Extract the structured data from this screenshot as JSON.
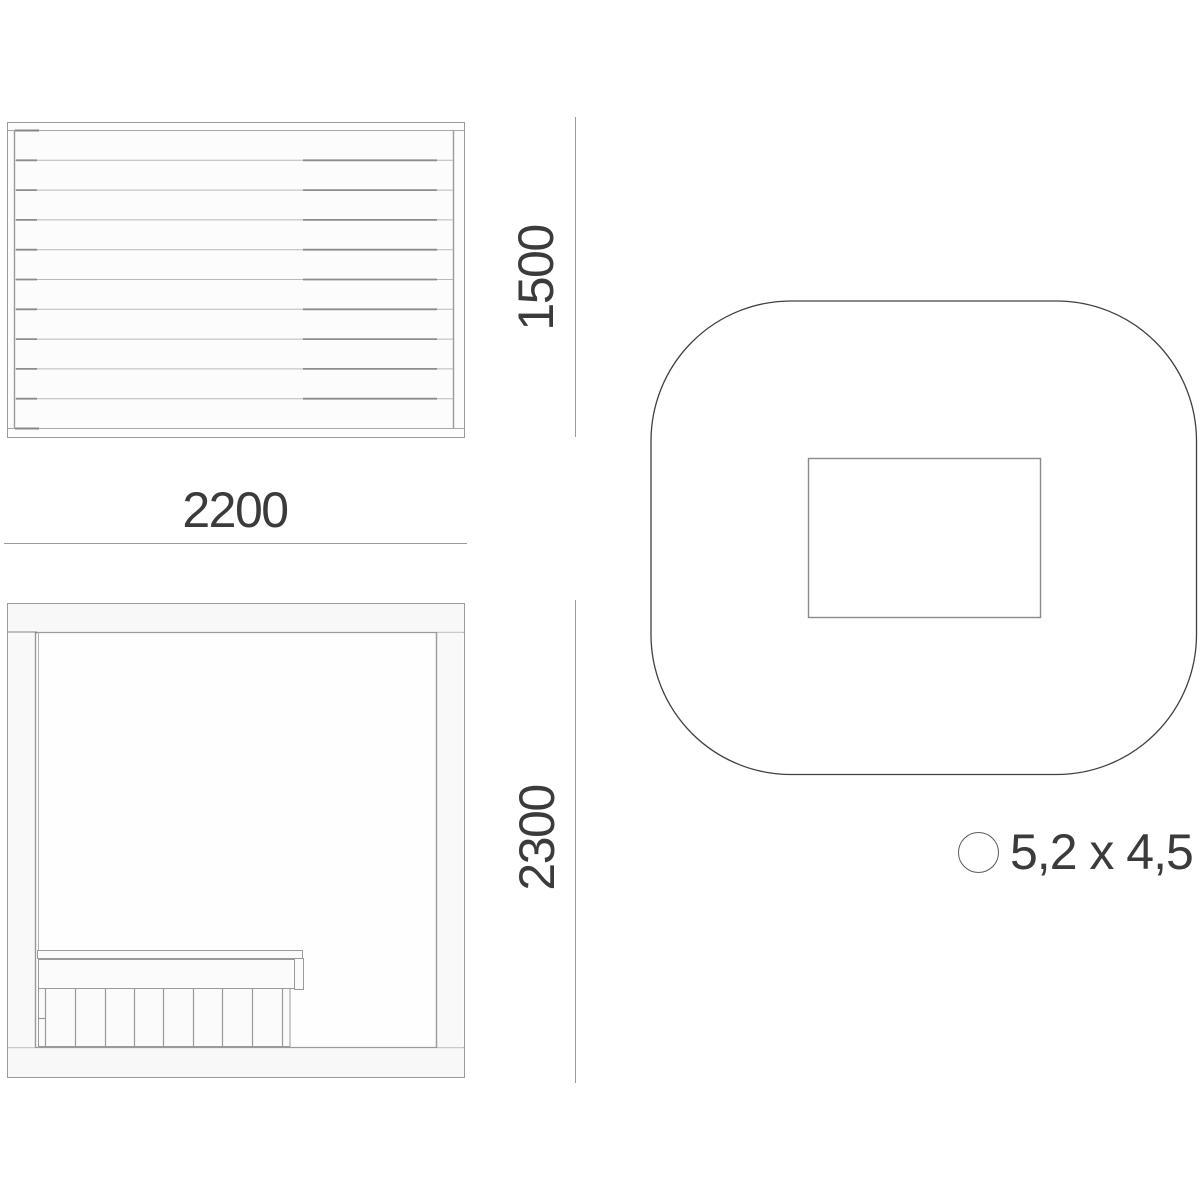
{
  "page": {
    "background_color": "#ffffff",
    "line_color": "#9a9a9a",
    "text_color": "#3b3b3b"
  },
  "views": {
    "top_view": {
      "name": "roof top view with slats",
      "slat_count": 10
    },
    "front_view": {
      "name": "cabin front elevation with bench"
    },
    "plan_view": {
      "name": "rounded-square site plan with inner rectangle"
    }
  },
  "dimensions": {
    "side_height": "1500",
    "top_width": "2200",
    "front_height": "2300"
  },
  "footprint": {
    "icon": "circle-icon",
    "size_label": "5,2 x 4,5"
  }
}
